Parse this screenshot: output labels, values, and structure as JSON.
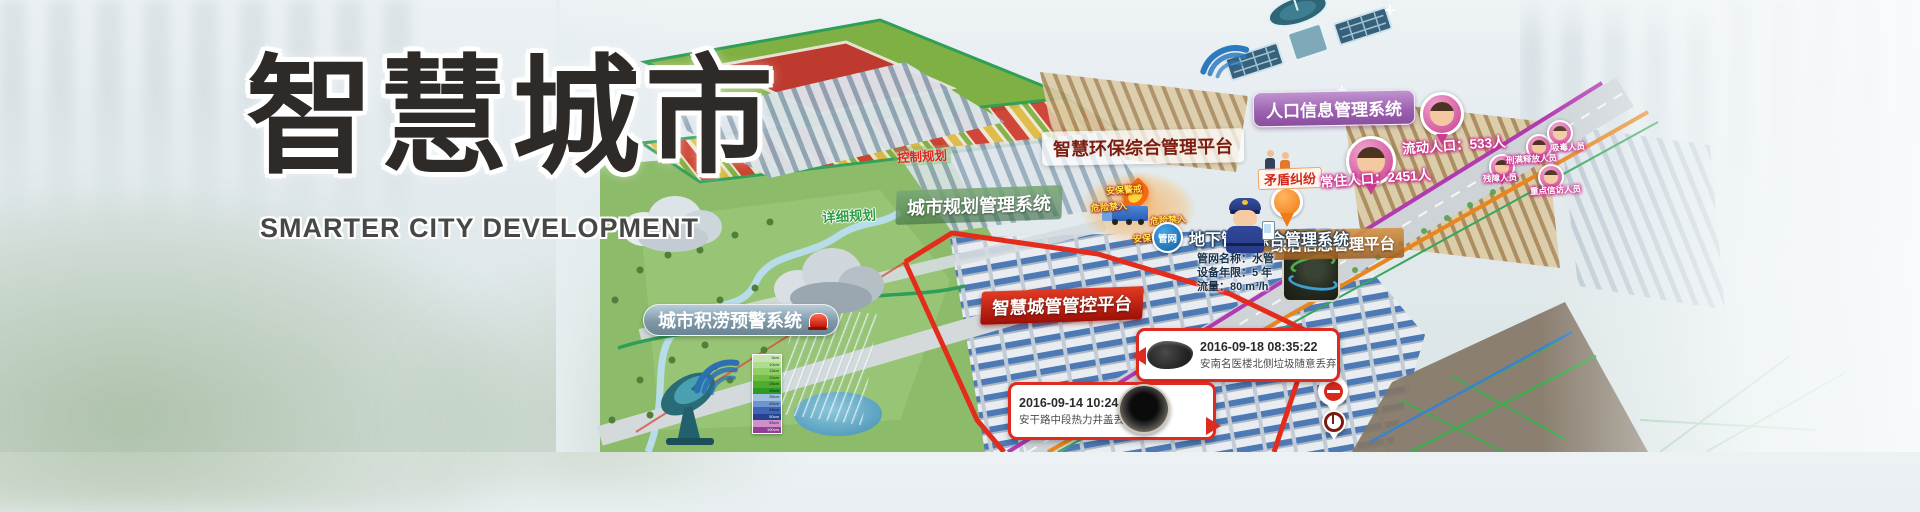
{
  "banner": {
    "title": "智慧城市",
    "subtitle": "SMARTER CITY DEVELOPMENT"
  },
  "systems": {
    "env": "智慧环保综合管理平台",
    "planning": "城市规划管理系统",
    "population": "人口信息管理系统",
    "governance": "综治信息管理平台",
    "city_mgmt": "智慧城管管控平台",
    "pipe": "地下管网综合管理系统",
    "pipe_badge": "管网",
    "flood": "城市积涝预警系统"
  },
  "planning_tags": {
    "control": "控制规划",
    "detailed": "详细规划"
  },
  "population": {
    "resident": "常住人口：2451人",
    "floating": "流动人口：533人",
    "dispute": "矛盾纠纷",
    "tags": [
      "残障人员",
      "刑满释放人员",
      "吸毒人员",
      "重点信访人员"
    ]
  },
  "fire_zone": {
    "warn_top": "安保警戒",
    "no_entry_left": "危险禁入",
    "no_entry_right": "危险禁入",
    "warn_bottom": "安保警戒"
  },
  "callouts": [
    {
      "time": "2016-09-18 08:35:22",
      "desc": "安南名医楼北侧垃圾随意丢弃"
    },
    {
      "time": "2016-09-14 10:24:15",
      "desc": "安干路中段热力井盖丢失"
    }
  ],
  "pipe_info": {
    "name": "管网名称：水管",
    "age": "设备年限：5 年",
    "flow": "流量：80 m³/h"
  },
  "rain_legend": [
    "5cm",
    "10cm",
    "15cm",
    "20cm",
    "25cm",
    "30cm",
    "35cm",
    "40cm",
    "45cm",
    "50cm",
    "55cm",
    "100cm"
  ],
  "colors": {
    "accent_red": "#d8281c",
    "accent_green": "#3f9e57",
    "accent_purple": "#9a5fae",
    "accent_orange": "#d0872e",
    "accent_blue": "#1f7fc9",
    "pin_pink": "#cf4f9b"
  }
}
